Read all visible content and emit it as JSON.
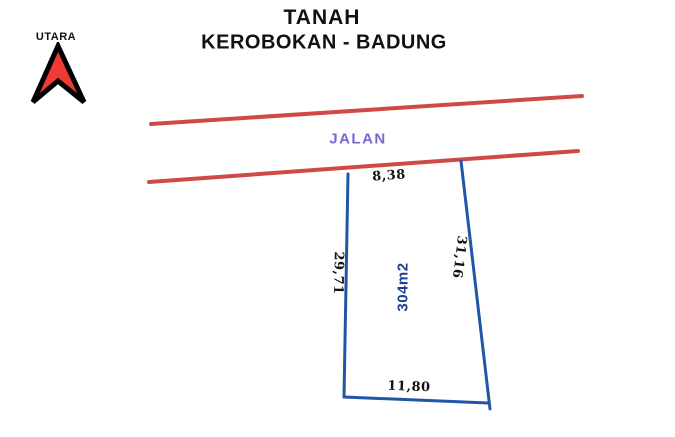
{
  "title": {
    "line1": "TANAH",
    "line2": "KEROBOKAN - BADUNG"
  },
  "compass": {
    "label": "UTARA",
    "arrow_fill": "#ee3b33",
    "arrow_outline": "#000000"
  },
  "road": {
    "label": "JALAN",
    "label_color": "#7568d4",
    "line_color": "#cf4a46"
  },
  "plot": {
    "area_label": "304m2",
    "area_color": "#1c3f94",
    "line_color": "#2156a5",
    "dimensions": {
      "top": "8,38",
      "left": "29,71",
      "right": "31,16",
      "bottom": "11,80"
    }
  }
}
